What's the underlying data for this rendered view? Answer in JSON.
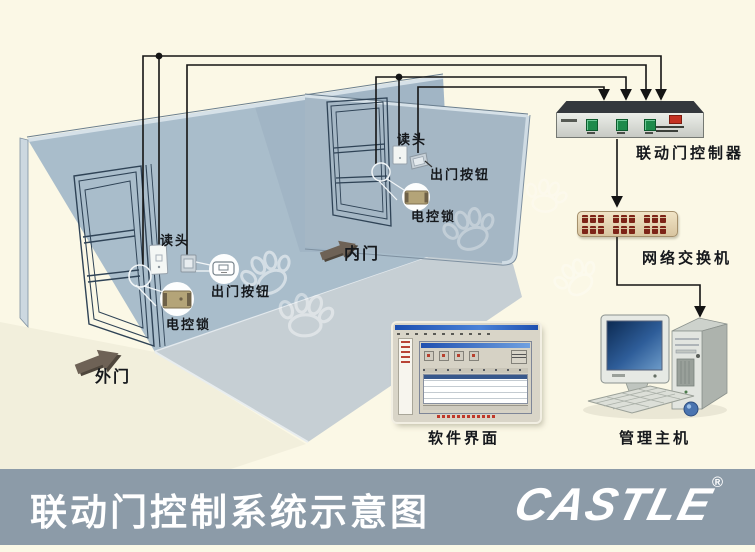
{
  "scene": {
    "room": {
      "outer_door": {
        "door_label": "外门",
        "reader_label": "读头",
        "exit_button_label": "出门按钮",
        "lock_label": "电控锁"
      },
      "inner_door": {
        "door_label": "内门",
        "reader_label": "读头",
        "exit_button_label": "出门按钮",
        "lock_label": "电控锁"
      }
    },
    "equipment": {
      "controller_label": "联动门控制器",
      "switch_label": "网络交换机",
      "software_label": "软件界面",
      "host_label": "管理主机"
    }
  },
  "footer": {
    "title": "联动门控制系统示意图",
    "logo_text": "CASTLE",
    "registered_mark": "®"
  },
  "colors": {
    "background": "#FBF8E6",
    "footer_bar": "#8C9BA8",
    "footer_text": "#FFFFFF",
    "wall": "#A9BDCB",
    "wall_right": "#A5B7C5",
    "floor": "#C6CFD4",
    "outside_ground": "#F2EFDC",
    "wire": "#141414",
    "controller_button_green": "#1D8A4B",
    "controller_indicator_red": "#C43122",
    "switch_body_tan": "#E3D3B4",
    "switch_port_maroon": "#7D2417",
    "lock_body_tan": "#B4A478",
    "monitor_screen_blue": "#1C3F72"
  }
}
